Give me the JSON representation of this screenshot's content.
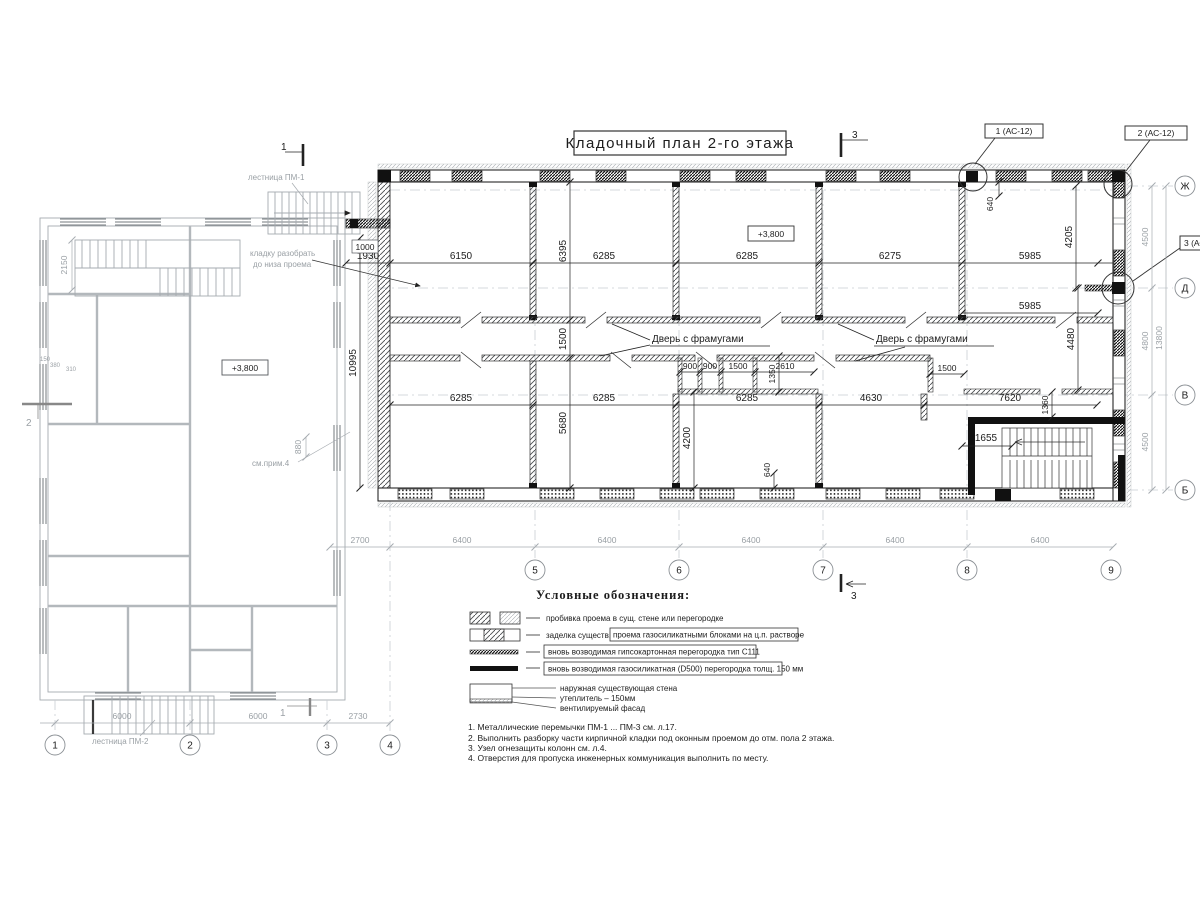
{
  "title": "Кладочный план 2-го этажа",
  "levels": {
    "main": "+3,800",
    "left": "+3,800"
  },
  "door_label": "Дверь с фрамугами",
  "callouts": {
    "c1": "1 (АС-12)",
    "c2": "2 (АС-12)",
    "c3": "3 (АС-12)"
  },
  "sections": {
    "s1": "1",
    "s2": "2",
    "s3": "3"
  },
  "axes": {
    "bottom_left": [
      "1",
      "2",
      "3",
      "4"
    ],
    "bottom_main": [
      "5",
      "6",
      "7",
      "8",
      "9"
    ],
    "right": [
      "Ж",
      "Д",
      "В",
      "Б"
    ]
  },
  "dims": {
    "top_row": [
      "1930",
      "6150",
      "6285",
      "6285",
      "6275",
      "5985"
    ],
    "row2": [
      "6285",
      "6285",
      "6285",
      "4630",
      "7620"
    ],
    "corridor": [
      "900",
      "900",
      "1500",
      "2610"
    ],
    "corridor_right": "1500",
    "v10995": "10995",
    "v6395": "6395",
    "v1500": "1500",
    "v5680": "5680",
    "v4200": "4200",
    "v640a": "640",
    "v640b": "640",
    "v1350": "1350",
    "v1360": "1360",
    "v4480": "4480",
    "v4205": "4205",
    "h5985": "5985",
    "h1655": "1655",
    "bottom_chain": [
      "2700",
      "6400",
      "6400",
      "6400",
      "6400",
      "6400"
    ],
    "right_chain": [
      "4500",
      "4800",
      "4500"
    ],
    "right_total": "13800",
    "left_chain": [
      "6000",
      "6000",
      "2730"
    ],
    "d2150": "2150",
    "d880": "880",
    "d1000": "1000",
    "left_small": [
      "150",
      "380",
      "310"
    ]
  },
  "annotations": {
    "stair_pm1": "лестница ПМ-1",
    "stair_pm2": "лестница ПМ-2",
    "demolish_1": "кладку разобрать",
    "demolish_2": "до низа проема",
    "see_note": "см.прим.4"
  },
  "legend": {
    "heading": "Условные обозначения:",
    "item1": "пробивка проема  в сущ. стене  или перегородке",
    "item2_prefix": "заделка существ.",
    "item2_boxed": "проема газосиликатными блоками на ц.п. растворе",
    "item3_boxed": "вновь возводимая гипсокартонная перегородка тип С111",
    "item4_boxed": "вновь возводимая газосиликатная (D500) перегородка толщ. 150 мм",
    "item5_lines": [
      "наружная существующая стена",
      "утеплитель – 150мм",
      "вентилируемый фасад"
    ]
  },
  "notes": [
    "1. Металлические перемычки  ПМ-1 ... ПМ-3 см. л.17.",
    "2. Выполнить разборку части кирпичной кладки под оконным проемом до отм. пола 2 этажа.",
    "3. Узел огнезащиты колонн см. л.4.",
    "4. Отверстия для пропуска инженерных коммуникация выполнить по месту."
  ]
}
